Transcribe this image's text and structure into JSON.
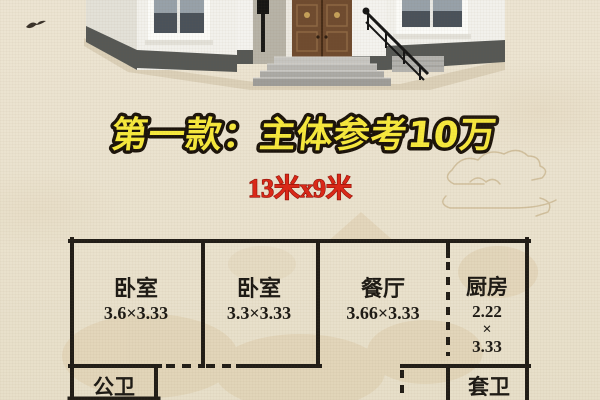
{
  "poster": {
    "title": "第一款：主体参考10万",
    "size_label": "13米x9米"
  },
  "floorplan": {
    "rooms": [
      {
        "name": "卧室",
        "dims": "3.6×3.33"
      },
      {
        "name": "卧室",
        "dims": "3.3×3.33"
      },
      {
        "name": "餐厅",
        "dims": "3.66×3.33"
      },
      {
        "name": "厨房",
        "dims_l1": "2.22",
        "dims_l2": "×",
        "dims_l3": "3.33"
      },
      {
        "name": "公卫"
      },
      {
        "name": "套卫"
      }
    ]
  },
  "colors": {
    "background": "#eae2ce",
    "title_fill": "#f7e93d",
    "title_outline": "#1b130a",
    "size_label_red": "#dc2718",
    "plan_line": "#211d17",
    "watermark_tan": "#d9c5a0"
  }
}
